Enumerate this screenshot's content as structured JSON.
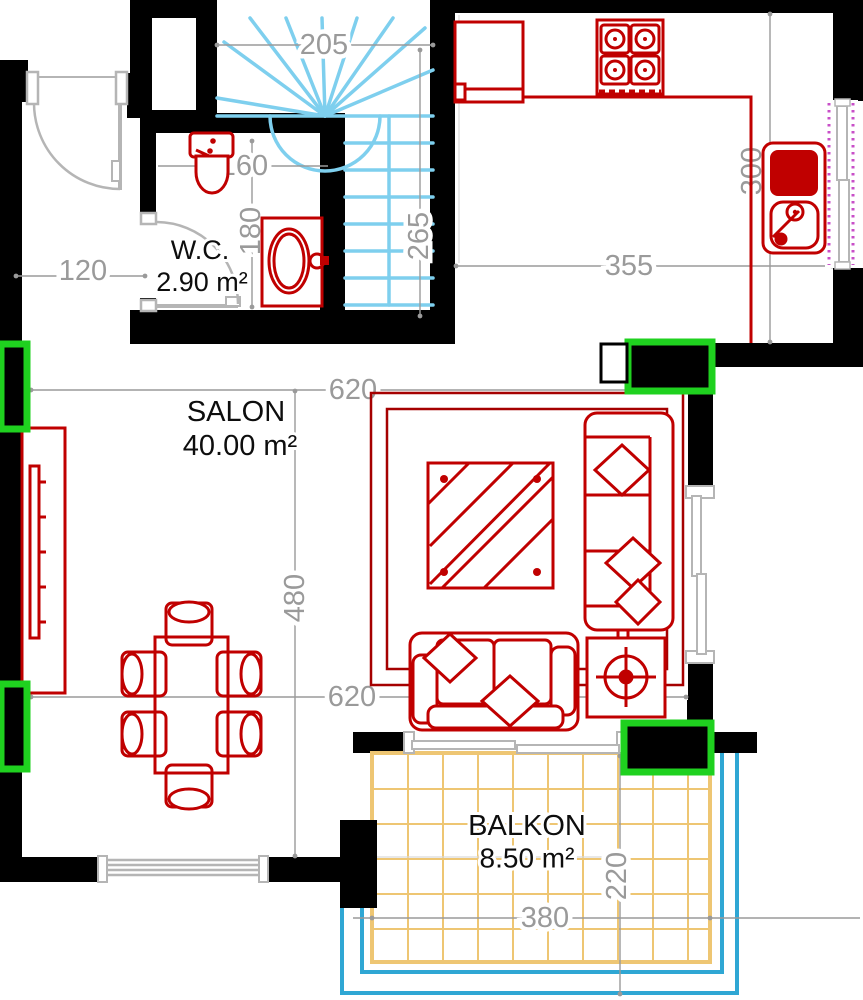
{
  "plan": {
    "rooms": [
      {
        "id": "wc",
        "name": "W.C.",
        "area": "2.90 m²"
      },
      {
        "id": "salon",
        "name": "SALON",
        "area": "40.00 m²"
      },
      {
        "id": "balkon",
        "name": "BALKON",
        "area": "8.50 m²"
      }
    ],
    "dimensions": [
      {
        "text": "205"
      },
      {
        "text": "265"
      },
      {
        "text": "300"
      },
      {
        "text": "355"
      },
      {
        "text": "120"
      },
      {
        "text": "160"
      },
      {
        "text": "180"
      },
      {
        "text": "620"
      },
      {
        "text": "480"
      },
      {
        "text": "620"
      },
      {
        "text": "220"
      },
      {
        "text": "380"
      }
    ],
    "colors": {
      "wall": "#000000",
      "furniture_red": "#c00000",
      "rug_red": "#a50000",
      "stair_cyan": "#7ecfee",
      "grid_sand": "#eec673",
      "railing_blue": "#2fa7d4",
      "column_green": "#1fd11f",
      "window_purple": "#c84fc8",
      "door_gray": "#b5b5b5",
      "dim_gray": "#9a9a9a"
    }
  }
}
